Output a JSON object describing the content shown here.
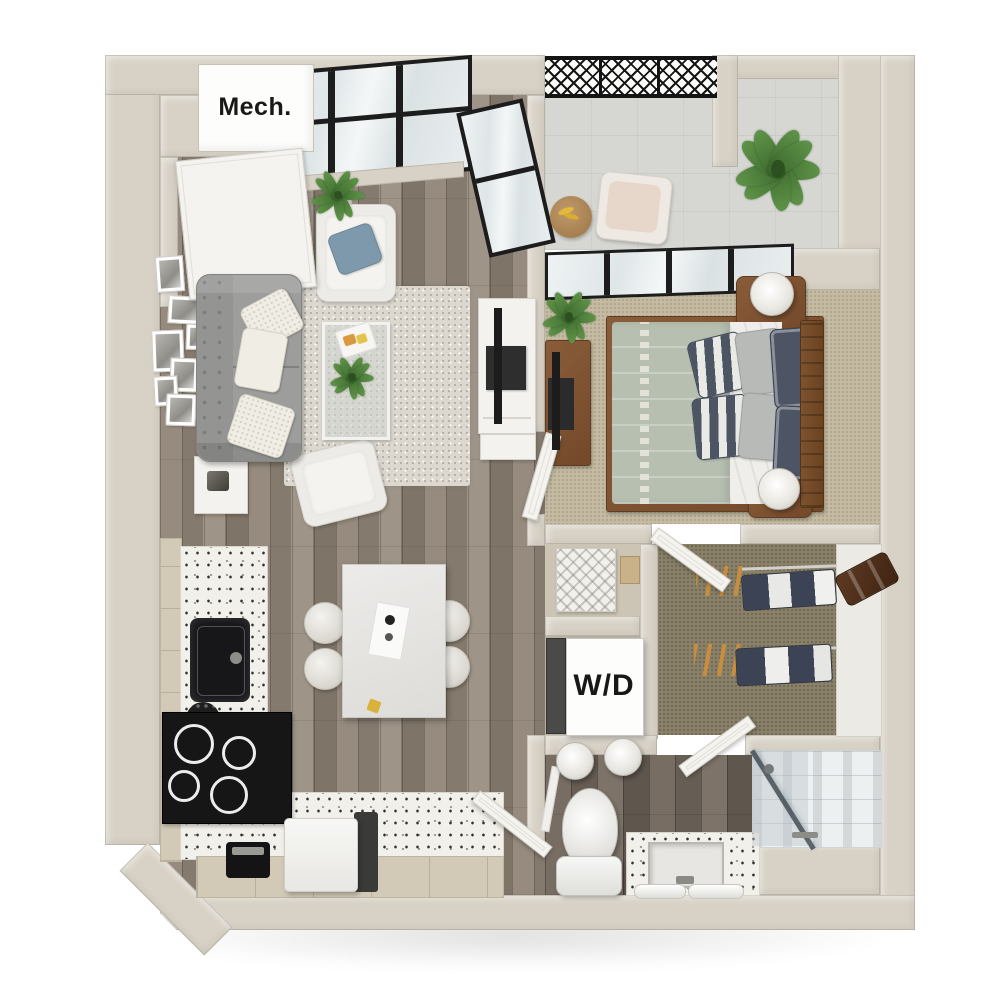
{
  "labels": {
    "mech_closet": "Mech.",
    "washer_dryer": "W/D"
  },
  "palette": {
    "wall": "#d8d2c6",
    "wood_floor": "#8e8478",
    "bathroom_floor": "#6f665d",
    "bedroom_carpet": "#c4bba2",
    "closet_carpet": "#8a8169",
    "balcony_floor": "#d6d6d3",
    "window_frame": "#1d1d1d",
    "terrazzo_counter": "#f1f0ea",
    "sofa_gray": "#9d9d9b",
    "duvet_sage": "#b7bfb1",
    "pillow_navy": "#4d5565",
    "accent_blue": "#7e99ac",
    "furniture_wood": "#8a5c39",
    "hanger_orange": "#cf8f3a",
    "appliance_black": "#1c1c1c"
  }
}
